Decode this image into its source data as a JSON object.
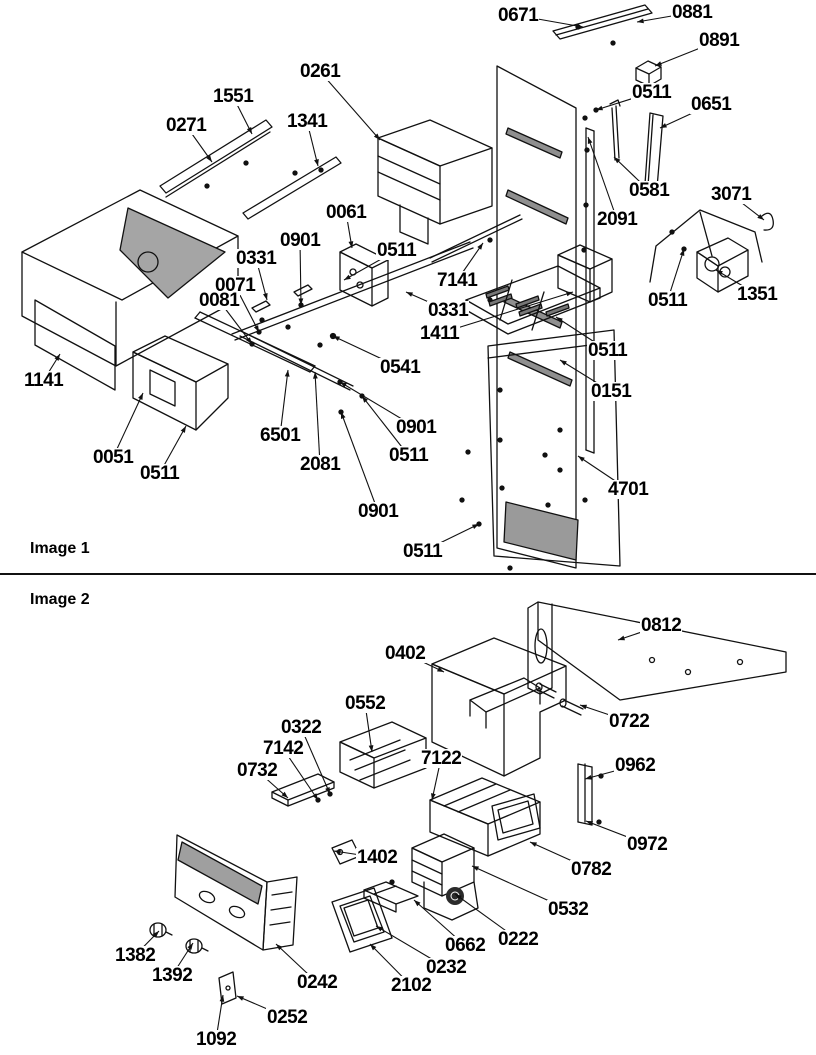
{
  "page": {
    "background": "#ffffff",
    "line_color": "#111111",
    "label_color": "#000000"
  },
  "figures": [
    {
      "id": "image1",
      "caption": "Image 1",
      "labels": [
        {
          "text": "0671",
          "x": 497,
          "y": 6,
          "tx": 583,
          "ty": 27
        },
        {
          "text": "0881",
          "x": 671,
          "y": 3,
          "tx": 637,
          "ty": 22
        },
        {
          "text": "0891",
          "x": 698,
          "y": 31,
          "tx": 655,
          "ty": 66
        },
        {
          "text": "0261",
          "x": 299,
          "y": 62,
          "tx": 380,
          "ty": 140
        },
        {
          "text": "1551",
          "x": 212,
          "y": 87,
          "tx": 252,
          "ty": 134
        },
        {
          "text": "0271",
          "x": 165,
          "y": 116,
          "tx": 212,
          "ty": 162
        },
        {
          "text": "1341",
          "x": 286,
          "y": 112,
          "tx": 318,
          "ty": 166
        },
        {
          "text": "0511",
          "x": 631,
          "y": 83,
          "tx": 596,
          "ty": 110
        },
        {
          "text": "0651",
          "x": 690,
          "y": 95,
          "tx": 660,
          "ty": 128
        },
        {
          "text": "0581",
          "x": 628,
          "y": 181,
          "tx": 614,
          "ty": 157
        },
        {
          "text": "2091",
          "x": 596,
          "y": 210,
          "tx": 588,
          "ty": 137
        },
        {
          "text": "3071",
          "x": 710,
          "y": 185,
          "tx": 764,
          "ty": 220
        },
        {
          "text": "0061",
          "x": 325,
          "y": 203,
          "tx": 352,
          "ty": 248
        },
        {
          "text": "0901",
          "x": 279,
          "y": 231,
          "tx": 301,
          "ty": 305
        },
        {
          "text": "0331",
          "x": 235,
          "y": 249,
          "tx": 267,
          "ty": 300
        },
        {
          "text": "0511",
          "x": 376,
          "y": 241,
          "tx": 344,
          "ty": 280
        },
        {
          "text": "0071",
          "x": 214,
          "y": 276,
          "tx": 259,
          "ty": 332
        },
        {
          "text": "0081",
          "x": 198,
          "y": 291,
          "tx": 252,
          "ty": 344
        },
        {
          "text": "7141",
          "x": 436,
          "y": 271,
          "tx": 483,
          "ty": 243
        },
        {
          "text": "0331",
          "x": 427,
          "y": 301,
          "tx": 406,
          "ty": 292
        },
        {
          "text": "1411",
          "x": 419,
          "y": 324,
          "tx": 573,
          "ty": 292
        },
        {
          "text": "0511",
          "x": 647,
          "y": 291,
          "tx": 684,
          "ty": 249
        },
        {
          "text": "1351",
          "x": 736,
          "y": 285,
          "tx": 716,
          "ty": 270
        },
        {
          "text": "0541",
          "x": 379,
          "y": 358,
          "tx": 333,
          "ty": 336
        },
        {
          "text": "0511",
          "x": 587,
          "y": 341,
          "tx": 556,
          "ty": 317
        },
        {
          "text": "0151",
          "x": 590,
          "y": 382,
          "tx": 560,
          "ty": 360
        },
        {
          "text": "1141",
          "x": 23,
          "y": 371,
          "tx": 60,
          "ty": 354
        },
        {
          "text": "0051",
          "x": 92,
          "y": 448,
          "tx": 143,
          "ty": 393
        },
        {
          "text": "0511",
          "x": 139,
          "y": 464,
          "tx": 186,
          "ty": 426
        },
        {
          "text": "6501",
          "x": 259,
          "y": 426,
          "tx": 288,
          "ty": 370
        },
        {
          "text": "2081",
          "x": 299,
          "y": 455,
          "tx": 315,
          "ty": 372
        },
        {
          "text": "0901",
          "x": 395,
          "y": 418,
          "tx": 340,
          "ty": 382
        },
        {
          "text": "0511",
          "x": 388,
          "y": 446,
          "tx": 362,
          "ty": 396
        },
        {
          "text": "0901",
          "x": 357,
          "y": 502,
          "tx": 341,
          "ty": 412
        },
        {
          "text": "4701",
          "x": 607,
          "y": 480,
          "tx": 578,
          "ty": 456
        },
        {
          "text": "0511",
          "x": 402,
          "y": 542,
          "tx": 479,
          "ty": 524
        }
      ]
    },
    {
      "id": "image2",
      "caption": "Image 2",
      "labels": [
        {
          "text": "0812",
          "x": 640,
          "y": 616,
          "tx": 618,
          "ty": 640
        },
        {
          "text": "0402",
          "x": 384,
          "y": 644,
          "tx": 444,
          "ty": 672
        },
        {
          "text": "0722",
          "x": 608,
          "y": 712,
          "tx": 580,
          "ty": 705
        },
        {
          "text": "0552",
          "x": 344,
          "y": 694,
          "tx": 372,
          "ty": 752
        },
        {
          "text": "0322",
          "x": 280,
          "y": 718,
          "tx": 330,
          "ty": 794
        },
        {
          "text": "7142",
          "x": 262,
          "y": 739,
          "tx": 318,
          "ty": 800
        },
        {
          "text": "0732",
          "x": 236,
          "y": 761,
          "tx": 288,
          "ty": 798
        },
        {
          "text": "7122",
          "x": 420,
          "y": 749,
          "tx": 432,
          "ty": 800
        },
        {
          "text": "0962",
          "x": 614,
          "y": 756,
          "tx": 585,
          "ty": 779
        },
        {
          "text": "0972",
          "x": 626,
          "y": 835,
          "tx": 586,
          "ty": 821
        },
        {
          "text": "1402",
          "x": 356,
          "y": 848,
          "tx": 334,
          "ty": 851
        },
        {
          "text": "0782",
          "x": 570,
          "y": 860,
          "tx": 530,
          "ty": 842
        },
        {
          "text": "0532",
          "x": 547,
          "y": 900,
          "tx": 472,
          "ty": 866
        },
        {
          "text": "0222",
          "x": 497,
          "y": 930,
          "tx": 455,
          "ty": 894
        },
        {
          "text": "0662",
          "x": 444,
          "y": 936,
          "tx": 414,
          "ty": 900
        },
        {
          "text": "0232",
          "x": 425,
          "y": 958,
          "tx": 376,
          "ty": 926
        },
        {
          "text": "2102",
          "x": 390,
          "y": 976,
          "tx": 370,
          "ty": 944
        },
        {
          "text": "1382",
          "x": 114,
          "y": 946,
          "tx": 159,
          "ty": 931
        },
        {
          "text": "1392",
          "x": 151,
          "y": 966,
          "tx": 193,
          "ty": 943
        },
        {
          "text": "0242",
          "x": 296,
          "y": 973,
          "tx": 276,
          "ty": 944
        },
        {
          "text": "0252",
          "x": 266,
          "y": 1008,
          "tx": 237,
          "ty": 996
        },
        {
          "text": "1092",
          "x": 195,
          "y": 1030,
          "tx": 223,
          "ty": 995
        }
      ]
    }
  ]
}
